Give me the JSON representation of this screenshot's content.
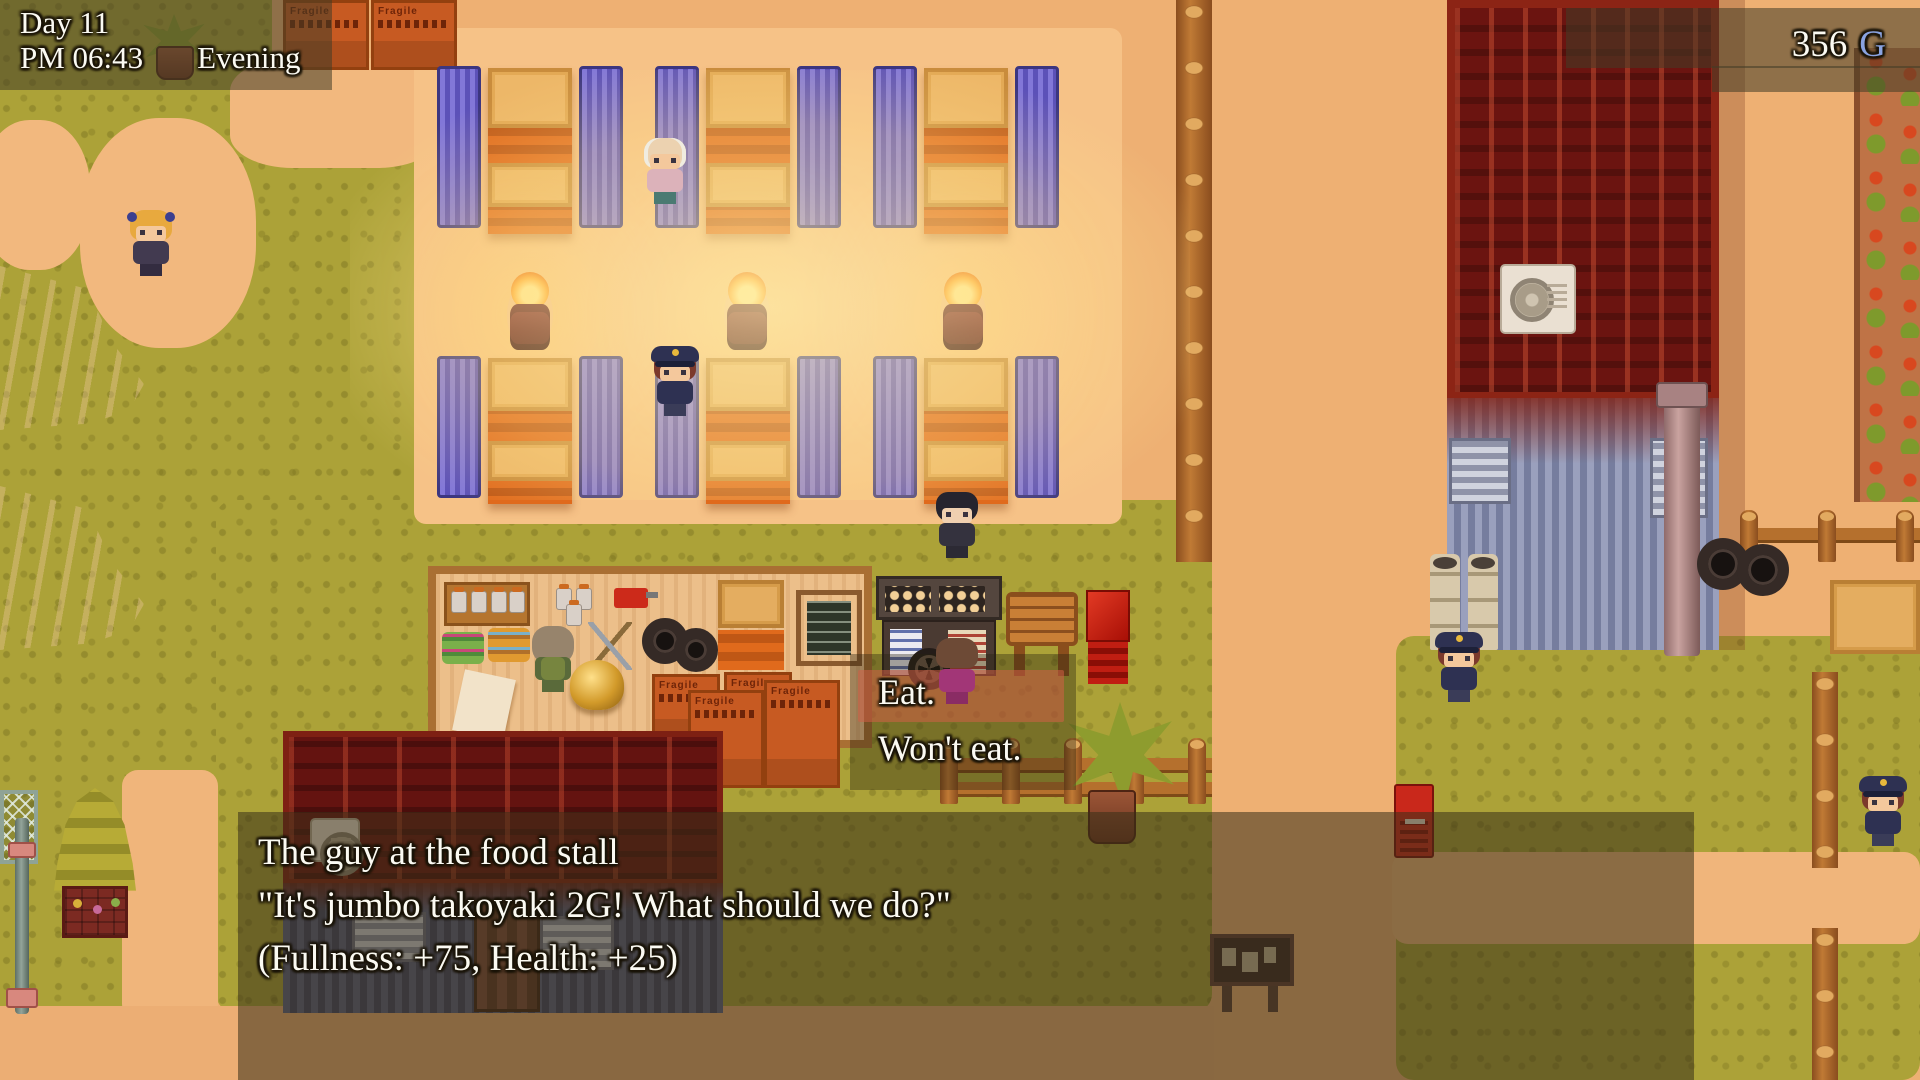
{
  "hud": {
    "day": "Day 11",
    "time": "PM 06:43",
    "period": "Evening",
    "gold": {
      "amount": "356",
      "unit": "G"
    }
  },
  "choice_menu": {
    "options": [
      {
        "label": "Eat."
      },
      {
        "label": "Won't eat."
      }
    ],
    "selected_index": 0
  },
  "dialogue": {
    "lines": [
      "The guy at the food stall",
      "\"It's jumbo takoyaki 2G! What should we do?\"",
      "(Fullness: +75, Health: +25)"
    ]
  },
  "scene": {
    "crate_label": "Fragile",
    "entities": [
      "market-stall-booths",
      "fire-barrels",
      "takoyaki-cart",
      "food-stall-floor",
      "sign-board",
      "red-banner-stand",
      "police-officers",
      "old-man",
      "blonde-girl",
      "suit-man",
      "stall-vendor",
      "player-character",
      "shop-building",
      "warehouse-building",
      "vegetable-garden",
      "notice-board",
      "vending-machine",
      "tents",
      "tree",
      "net-fence",
      "log-fences",
      "cargo-crates"
    ]
  },
  "colors": {
    "gold_unit_text": "#8aa3e0",
    "hud_text": "#fbfaf2",
    "selection_highlight": "#d25f46",
    "overlay": "#423c26",
    "grass": "#aca238",
    "dirt": "#eeb073",
    "fire_glow": "#ffe9a8",
    "curtain_purple": "#7b6fd3",
    "roof_red": "#6b1410",
    "stall_wood": "#edb768"
  }
}
